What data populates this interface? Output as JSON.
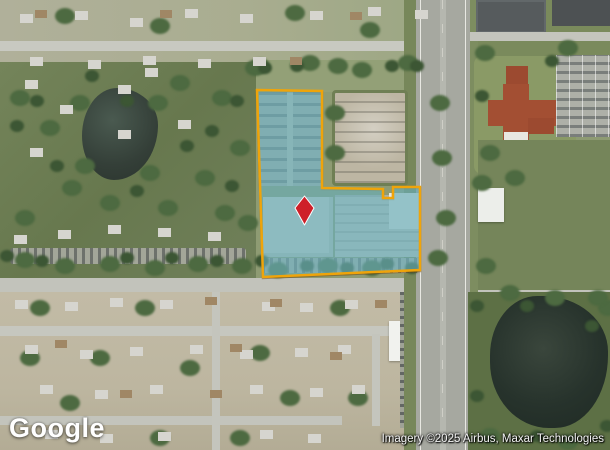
{
  "map": {
    "provider": "Google",
    "watermark": "Google",
    "attribution": "Imagery ©2025 Airbus, Maxar Technologies",
    "parcel": {
      "points": "257,90 322,91 322,188 383,189 383,198 393,198 393,187 420,187 420,270 263,277",
      "fill": "rgba(104,196,221,0.55)",
      "stroke": "#EFA40A",
      "stroke_width": "2.5"
    },
    "marker": {
      "transform": "translate(304.5,210.5)",
      "points": "0,-14.5 9.5,-2.5 0,14.5 -9.5,-2.5",
      "fill": "#CE2029",
      "stroke": "#FFFFFF",
      "stroke_width": "1"
    }
  }
}
